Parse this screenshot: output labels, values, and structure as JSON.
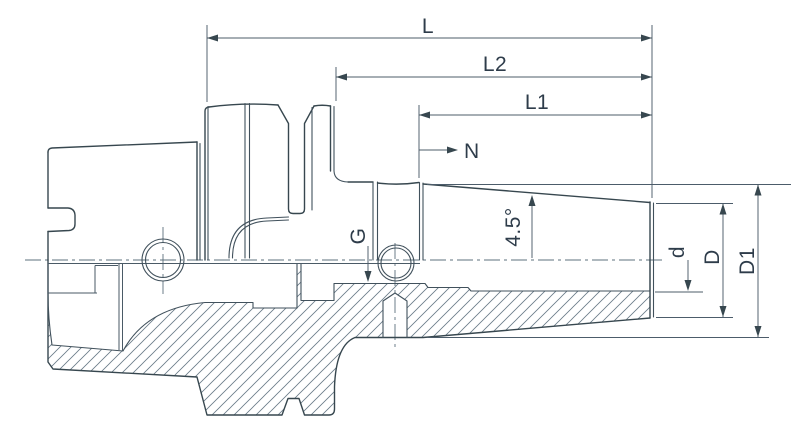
{
  "drawing": {
    "title": "Shrink fit tool holder cross-section drawing",
    "colors": {
      "line": "#37474f",
      "dimension_line": "#4c5c6a",
      "text": "#2e3c4a",
      "background": "#ffffff"
    },
    "labels": {
      "L": "L",
      "L2": "L2",
      "L1": "L1",
      "N": "N",
      "G": "G",
      "angle": "4.5°",
      "d": "d",
      "D": "D",
      "D1": "D1"
    }
  }
}
